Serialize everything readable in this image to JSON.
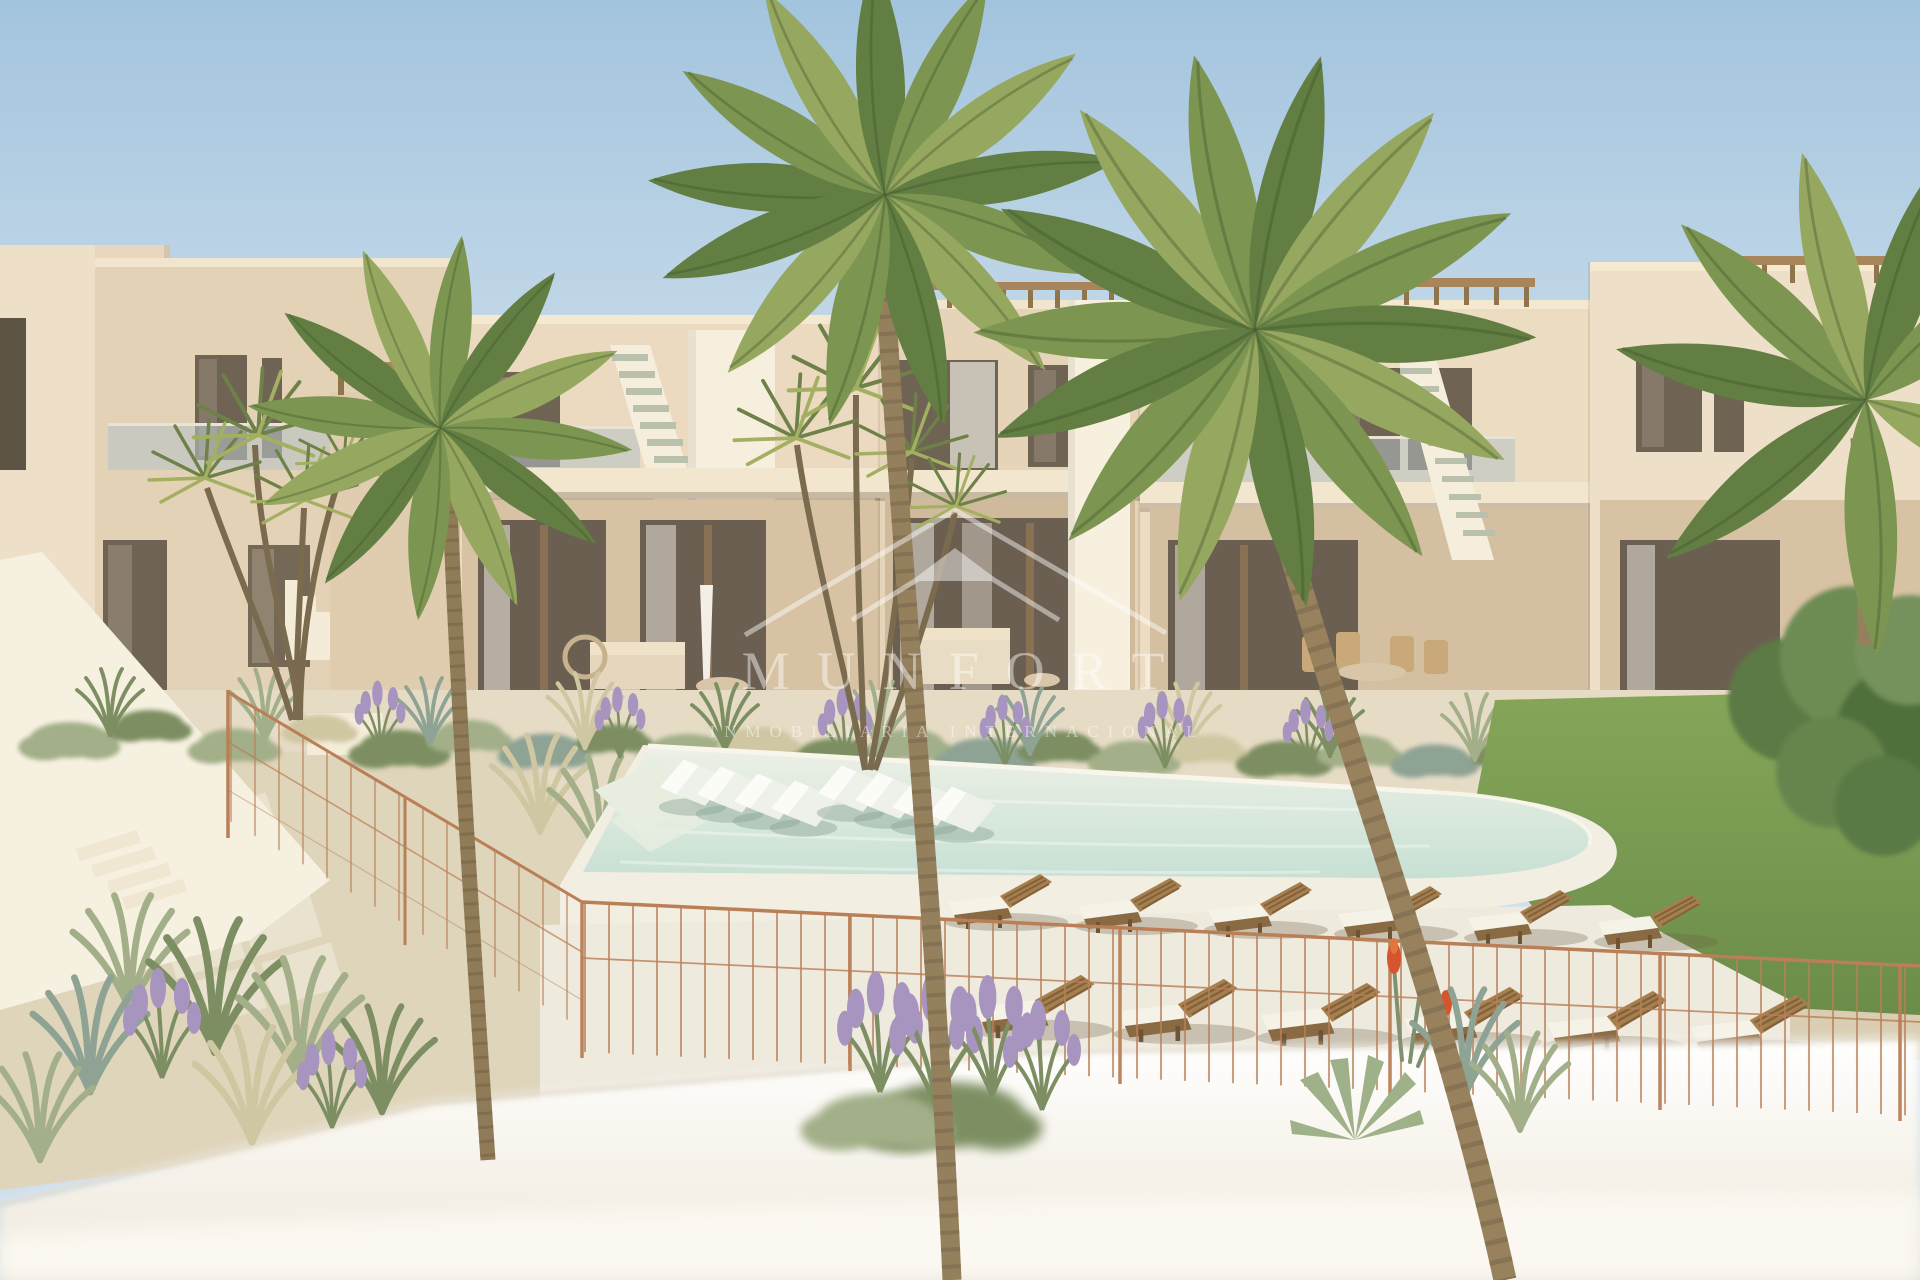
{
  "watermark": {
    "brand": "MUNFORT",
    "tagline": "INMOBILIARIA INTERNACIONAL",
    "color": "#ffffff",
    "logo": "roof-chevron-logo"
  },
  "scene": {
    "type": "3d-architectural-render",
    "subject": "two-storey beige apartment complex with communal pool, landscaped gardens, palm trees, wooden sun loungers and a copper wire pool fence",
    "palette": {
      "sky_top": "#a3c4de",
      "sky_horizon": "#edf2f3",
      "facade_light": "#ecdcc3",
      "facade_mid": "#e4d2b6",
      "facade_shadow": "#d3bd9e",
      "window_glass": "#6f6354",
      "curtain": "#d8d2c8",
      "pergola_wood": "#ac8a5c",
      "stair_tread": "#b9c0ab",
      "pool_water_far": "#edf0e6",
      "pool_water_near": "#c8e0d4",
      "pool_deck": "#f2eee2",
      "lawn": "#7fa055",
      "lounger_wood": "#a67f4e",
      "towel": "#f5f2e8",
      "fence_copper": "#b97f56",
      "plant_sage": "#a2af88",
      "lavender": "#a795c0",
      "gravel": "#e6dcc6",
      "foreground_wall": "#faf7ef"
    }
  }
}
